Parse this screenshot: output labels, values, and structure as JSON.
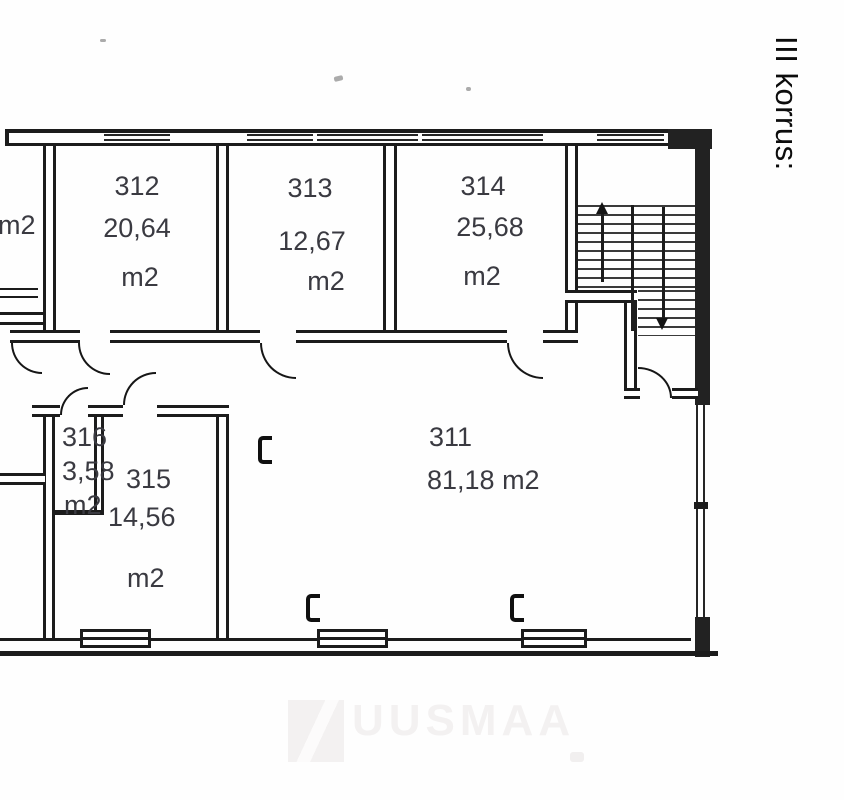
{
  "floor_label": "III korrus:",
  "rooms": {
    "left_partial": {
      "unit": "m2"
    },
    "r311": {
      "number": "311",
      "area": "81,18 m2"
    },
    "r312": {
      "number": "312",
      "area": "20,64",
      "unit": "m2"
    },
    "r313": {
      "number": "313",
      "area": "12,67",
      "unit": "m2"
    },
    "r314": {
      "number": "314",
      "area": "25,68",
      "unit": "m2"
    },
    "r315": {
      "number": "315",
      "area": "14,56",
      "unit": "m2"
    },
    "r316": {
      "number": "316",
      "area": "3,58",
      "unit": "m2"
    }
  },
  "watermark": {
    "text": "UUSMAA"
  }
}
